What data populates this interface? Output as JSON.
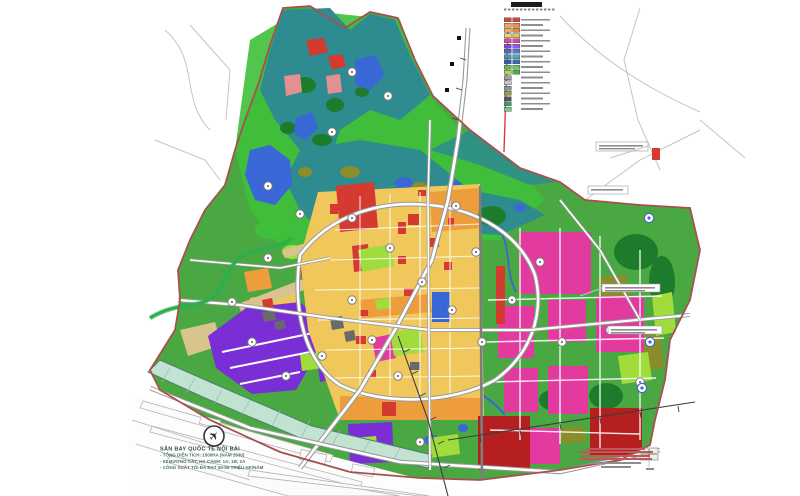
{
  "map_title": "Quy hoạch sử dụng đất (zoning master plan)",
  "palette": {
    "boundary": "#a85050",
    "baseGreen": "#4aa843",
    "brightGreen": "#3fbf3a",
    "teal": "#2e8b8f",
    "forestDark": "#1d7c2c",
    "olive": "#8a8d2b",
    "lime": "#9fdc3c",
    "yellow": "#f0c75a",
    "orange": "#ee9d3d",
    "tan": "#d9c48e",
    "red": "#d43a2f",
    "darkRed": "#b51f1f",
    "salmon": "#e59090",
    "magenta": "#e23a9e",
    "purple": "#7a2fd6",
    "blue": "#3a67d6",
    "roadCasing": "#9a9a9a",
    "bufferTeal": "#c2e2d2"
  },
  "legend": {
    "items": [
      {
        "c1": "#d84335",
        "c2": "#d84335"
      },
      {
        "c1": "#f2a45c",
        "c2": "#ef8f3a"
      },
      {
        "c1": "#f0b052",
        "c2": "#e8852e"
      },
      {
        "c1": "#f4d468",
        "c2": "#e8c44a"
      },
      {
        "c1": "#e245a2",
        "c2": "#e245a2"
      },
      {
        "c1": "#8744d8",
        "c2": "#9a55e8"
      },
      {
        "c1": "#4a62d8",
        "c2": "#5a74e8"
      },
      {
        "c1": "#2fa3a6",
        "c2": "#3fb3b6"
      },
      {
        "c1": "#2f55c0",
        "c2": "#3f65d0"
      },
      {
        "c1": "#4fc04f",
        "c2": "#5fd05f"
      },
      {
        "c1": "#9fe04f",
        "c2": "#4fae46"
      },
      {
        "c1": "#a0a0a0",
        "c2": null
      },
      {
        "c1": "#c8c8c8",
        "c2": null
      },
      {
        "c1": "#8494a4",
        "c2": null
      },
      {
        "c1": "#9a9a3f",
        "c2": null
      },
      {
        "c1": "#565656",
        "c2": null
      },
      {
        "c1": "#3fa060",
        "c2": null
      },
      {
        "c1": "#79c890",
        "c2": null
      }
    ]
  },
  "airport": {
    "title": "SÂN BAY QUỐC TẾ NỘI BÀI",
    "lines": [
      "- TỔNG DIỆN TÍCH: 1500HA (NĂM 2030)",
      "- 03 ĐƯỜNG CẤT, HẠ CÁNH: 1A; 1B; 2A",
      "- CÔNG SUẤT TỐI ĐA ĐẠT 50-55 TRIỆU HK/NĂM"
    ]
  }
}
